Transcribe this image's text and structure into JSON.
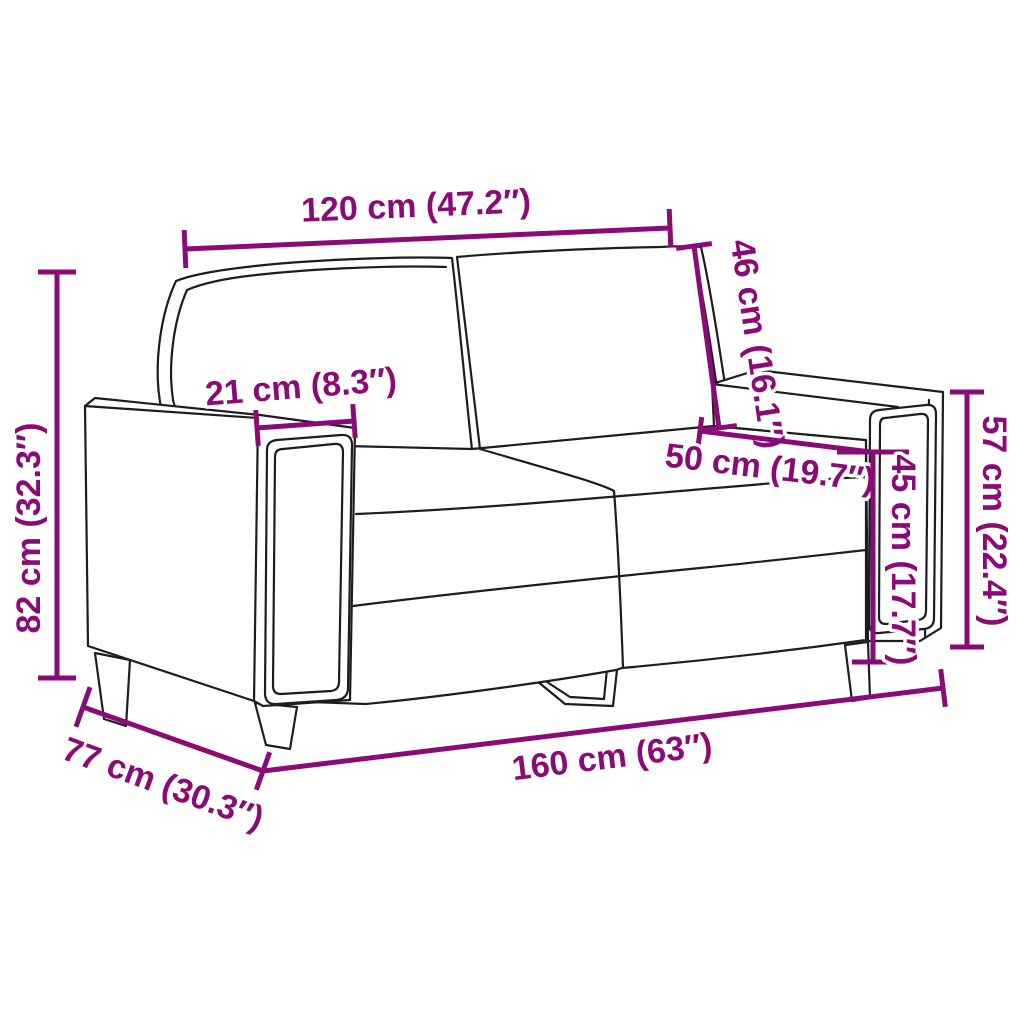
{
  "figure": {
    "type": "product-dimension-diagram",
    "subject": "2-seater sofa (loveseat) line drawing with measurement annotations",
    "background_color": "#ffffff",
    "annotation_color": "#8a0b76",
    "outline_color": "#1d1d1d"
  },
  "dimensions": [
    {
      "id": "back-width",
      "name": "back cushion width",
      "label": "120 cm (47.2″)",
      "cm": 120,
      "inches": 47.2,
      "x1": 185,
      "y1": 249,
      "x2": 670,
      "y2": 228,
      "tick_start": 19,
      "tick_end": 19,
      "lx": 416,
      "ly": 206,
      "rot": -2.4
    },
    {
      "id": "back-height",
      "name": "backrest height",
      "label": "46 cm (16.1″)",
      "cm": 46,
      "inches": 16.1,
      "x1": 694,
      "y1": 246,
      "x2": 719,
      "y2": 428,
      "tick_start": 18,
      "tick_end": 18,
      "lx": 757,
      "ly": 344,
      "rot": 81.5
    },
    {
      "id": "armrest-width",
      "name": "armrest width",
      "label": "21 cm (8.3″)",
      "cm": 21,
      "inches": 8.3,
      "x1": 257,
      "y1": 428,
      "x2": 354,
      "y2": 421,
      "tick_start": 18,
      "tick_end": 17,
      "lx": 301,
      "ly": 387,
      "rot": -4.5
    },
    {
      "id": "seat-depth",
      "name": "seat depth",
      "label": "50 cm (19.7″)",
      "cm": 50,
      "inches": 19.7,
      "x1": 700,
      "y1": 431,
      "x2": 871,
      "y2": 452,
      "tick_start": 14,
      "tick_end": 0,
      "lx": 770,
      "ly": 468,
      "rot": 6.8
    },
    {
      "id": "seat-height",
      "name": "seat height",
      "label": "45 cm (17.7″)",
      "cm": 45,
      "inches": 17.7,
      "x1": 873,
      "y1": 452,
      "x2": 873,
      "y2": 662,
      "tick_start": 36,
      "tick_end": 21,
      "lx": 903,
      "ly": 560,
      "rot": 90
    },
    {
      "id": "armrest-height",
      "name": "armrest height",
      "label": "57 cm (22.4″)",
      "cm": 57,
      "inches": 22.4,
      "x1": 967,
      "y1": 392,
      "x2": 967,
      "y2": 647,
      "tick_start": 17,
      "tick_end": 17,
      "lx": 994,
      "ly": 521,
      "rot": 90
    },
    {
      "id": "total-height",
      "name": "total height",
      "label": "82 cm (32.3″)",
      "cm": 82,
      "inches": 32.3,
      "x1": 57,
      "y1": 272,
      "x2": 57,
      "y2": 678,
      "tick_start": 19,
      "tick_end": 19,
      "lx": 29,
      "ly": 528,
      "rot": -90
    },
    {
      "id": "total-depth",
      "name": "total depth",
      "label": "77 cm (30.3″)",
      "cm": 77,
      "inches": 30.3,
      "x1": 83,
      "y1": 707,
      "x2": 263,
      "y2": 771,
      "tick_start": 21,
      "tick_end": 20,
      "lx": 163,
      "ly": 784,
      "rot": 20
    },
    {
      "id": "total-width",
      "name": "total width",
      "label": "160 cm (63″)",
      "cm": 160,
      "inches": 63,
      "x1": 263,
      "y1": 771,
      "x2": 943,
      "y2": 688,
      "tick_start": 0,
      "tick_end": 19,
      "lx": 612,
      "ly": 757,
      "rot": -7
    }
  ]
}
